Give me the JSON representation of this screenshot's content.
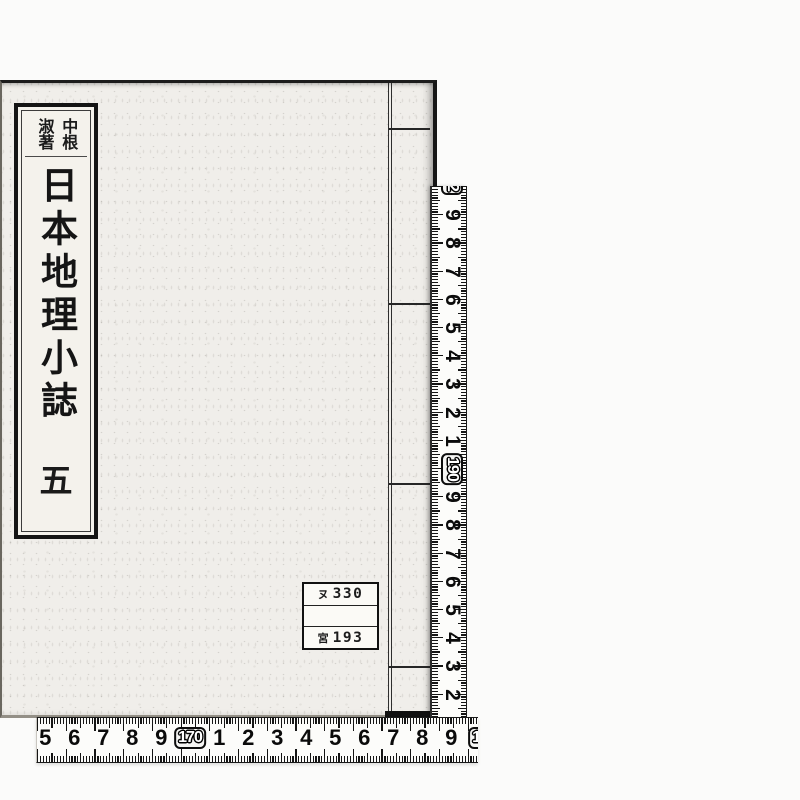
{
  "colors": {
    "scan_background": "#fbfbfa",
    "cover_paper": "#f0eeea",
    "label_paper": "#f4f2ec",
    "ink": "#141414",
    "tape": "#fcfcfa"
  },
  "book": {
    "author_label": {
      "text": "中根淑著",
      "columns": [
        "中根",
        "淑著"
      ]
    },
    "title_label": {
      "title": "日本地理小誌",
      "volume": "五"
    },
    "call_number_label": {
      "rows": [
        {
          "prefix": "ヌ",
          "number": "330"
        },
        {
          "prefix": "",
          "number": ""
        },
        {
          "prefix": "宮",
          "number": "193"
        }
      ]
    }
  },
  "rulers": {
    "vertical": {
      "orientation": "vertical",
      "unit": "cm",
      "numbers": [
        {
          "label": "2",
          "boxed": true
        },
        {
          "label": "9"
        },
        {
          "label": "8"
        },
        {
          "label": "7"
        },
        {
          "label": "6"
        },
        {
          "label": "5"
        },
        {
          "label": "4"
        },
        {
          "label": "3"
        },
        {
          "label": "2"
        },
        {
          "label": "1"
        },
        {
          "label": "190",
          "boxed": true
        },
        {
          "label": "9"
        },
        {
          "label": "8"
        },
        {
          "label": "7"
        },
        {
          "label": "6"
        },
        {
          "label": "5"
        },
        {
          "label": "4"
        },
        {
          "label": "3"
        },
        {
          "label": "2"
        }
      ]
    },
    "horizontal": {
      "orientation": "horizontal",
      "unit": "cm",
      "numbers": [
        {
          "label": "5"
        },
        {
          "label": "6"
        },
        {
          "label": "7"
        },
        {
          "label": "8"
        },
        {
          "label": "9"
        },
        {
          "label": "170",
          "boxed": true
        },
        {
          "label": "1"
        },
        {
          "label": "2"
        },
        {
          "label": "3"
        },
        {
          "label": "4"
        },
        {
          "label": "5"
        },
        {
          "label": "6"
        },
        {
          "label": "7"
        },
        {
          "label": "8"
        },
        {
          "label": "9"
        },
        {
          "label": "18",
          "boxed": true
        }
      ]
    }
  }
}
